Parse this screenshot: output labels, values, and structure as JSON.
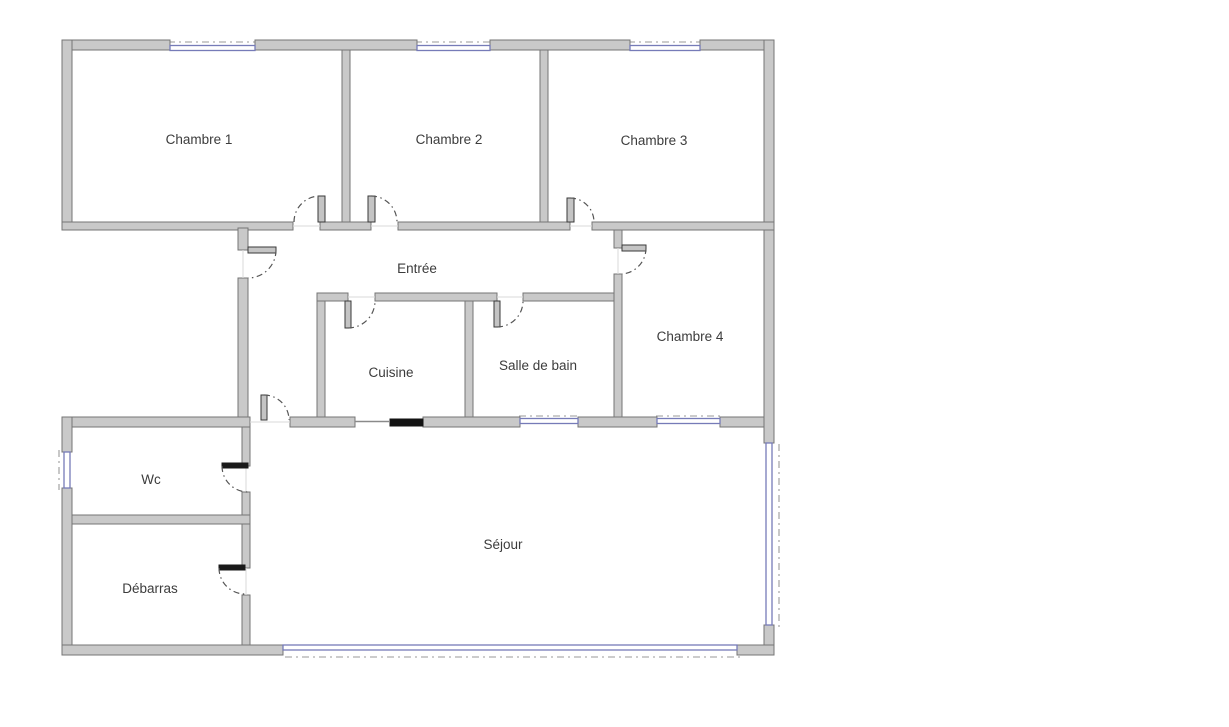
{
  "floorplan": {
    "rooms": [
      {
        "id": "chambre-1",
        "label": "Chambre 1"
      },
      {
        "id": "chambre-2",
        "label": "Chambre 2"
      },
      {
        "id": "chambre-3",
        "label": "Chambre 3"
      },
      {
        "id": "entree",
        "label": "Entrée"
      },
      {
        "id": "chambre-4",
        "label": "Chambre 4"
      },
      {
        "id": "cuisine",
        "label": "Cuisine"
      },
      {
        "id": "salle-de-bain",
        "label": "Salle de bain"
      },
      {
        "id": "wc",
        "label": "Wc"
      },
      {
        "id": "debarras",
        "label": "Débarras"
      },
      {
        "id": "sejour",
        "label": "Séjour"
      }
    ],
    "colors": {
      "background": "#ffffff",
      "wall_fill": "#c9c9c9",
      "wall_stroke": "#757575",
      "window_glazing": "#767bb8",
      "door_leaf": "#3a3a3a",
      "swing_arc": "#555555",
      "exterior_dash": "#9a9a9a",
      "label_text": "#3c3c3c",
      "solid_partition": "#131313"
    }
  }
}
